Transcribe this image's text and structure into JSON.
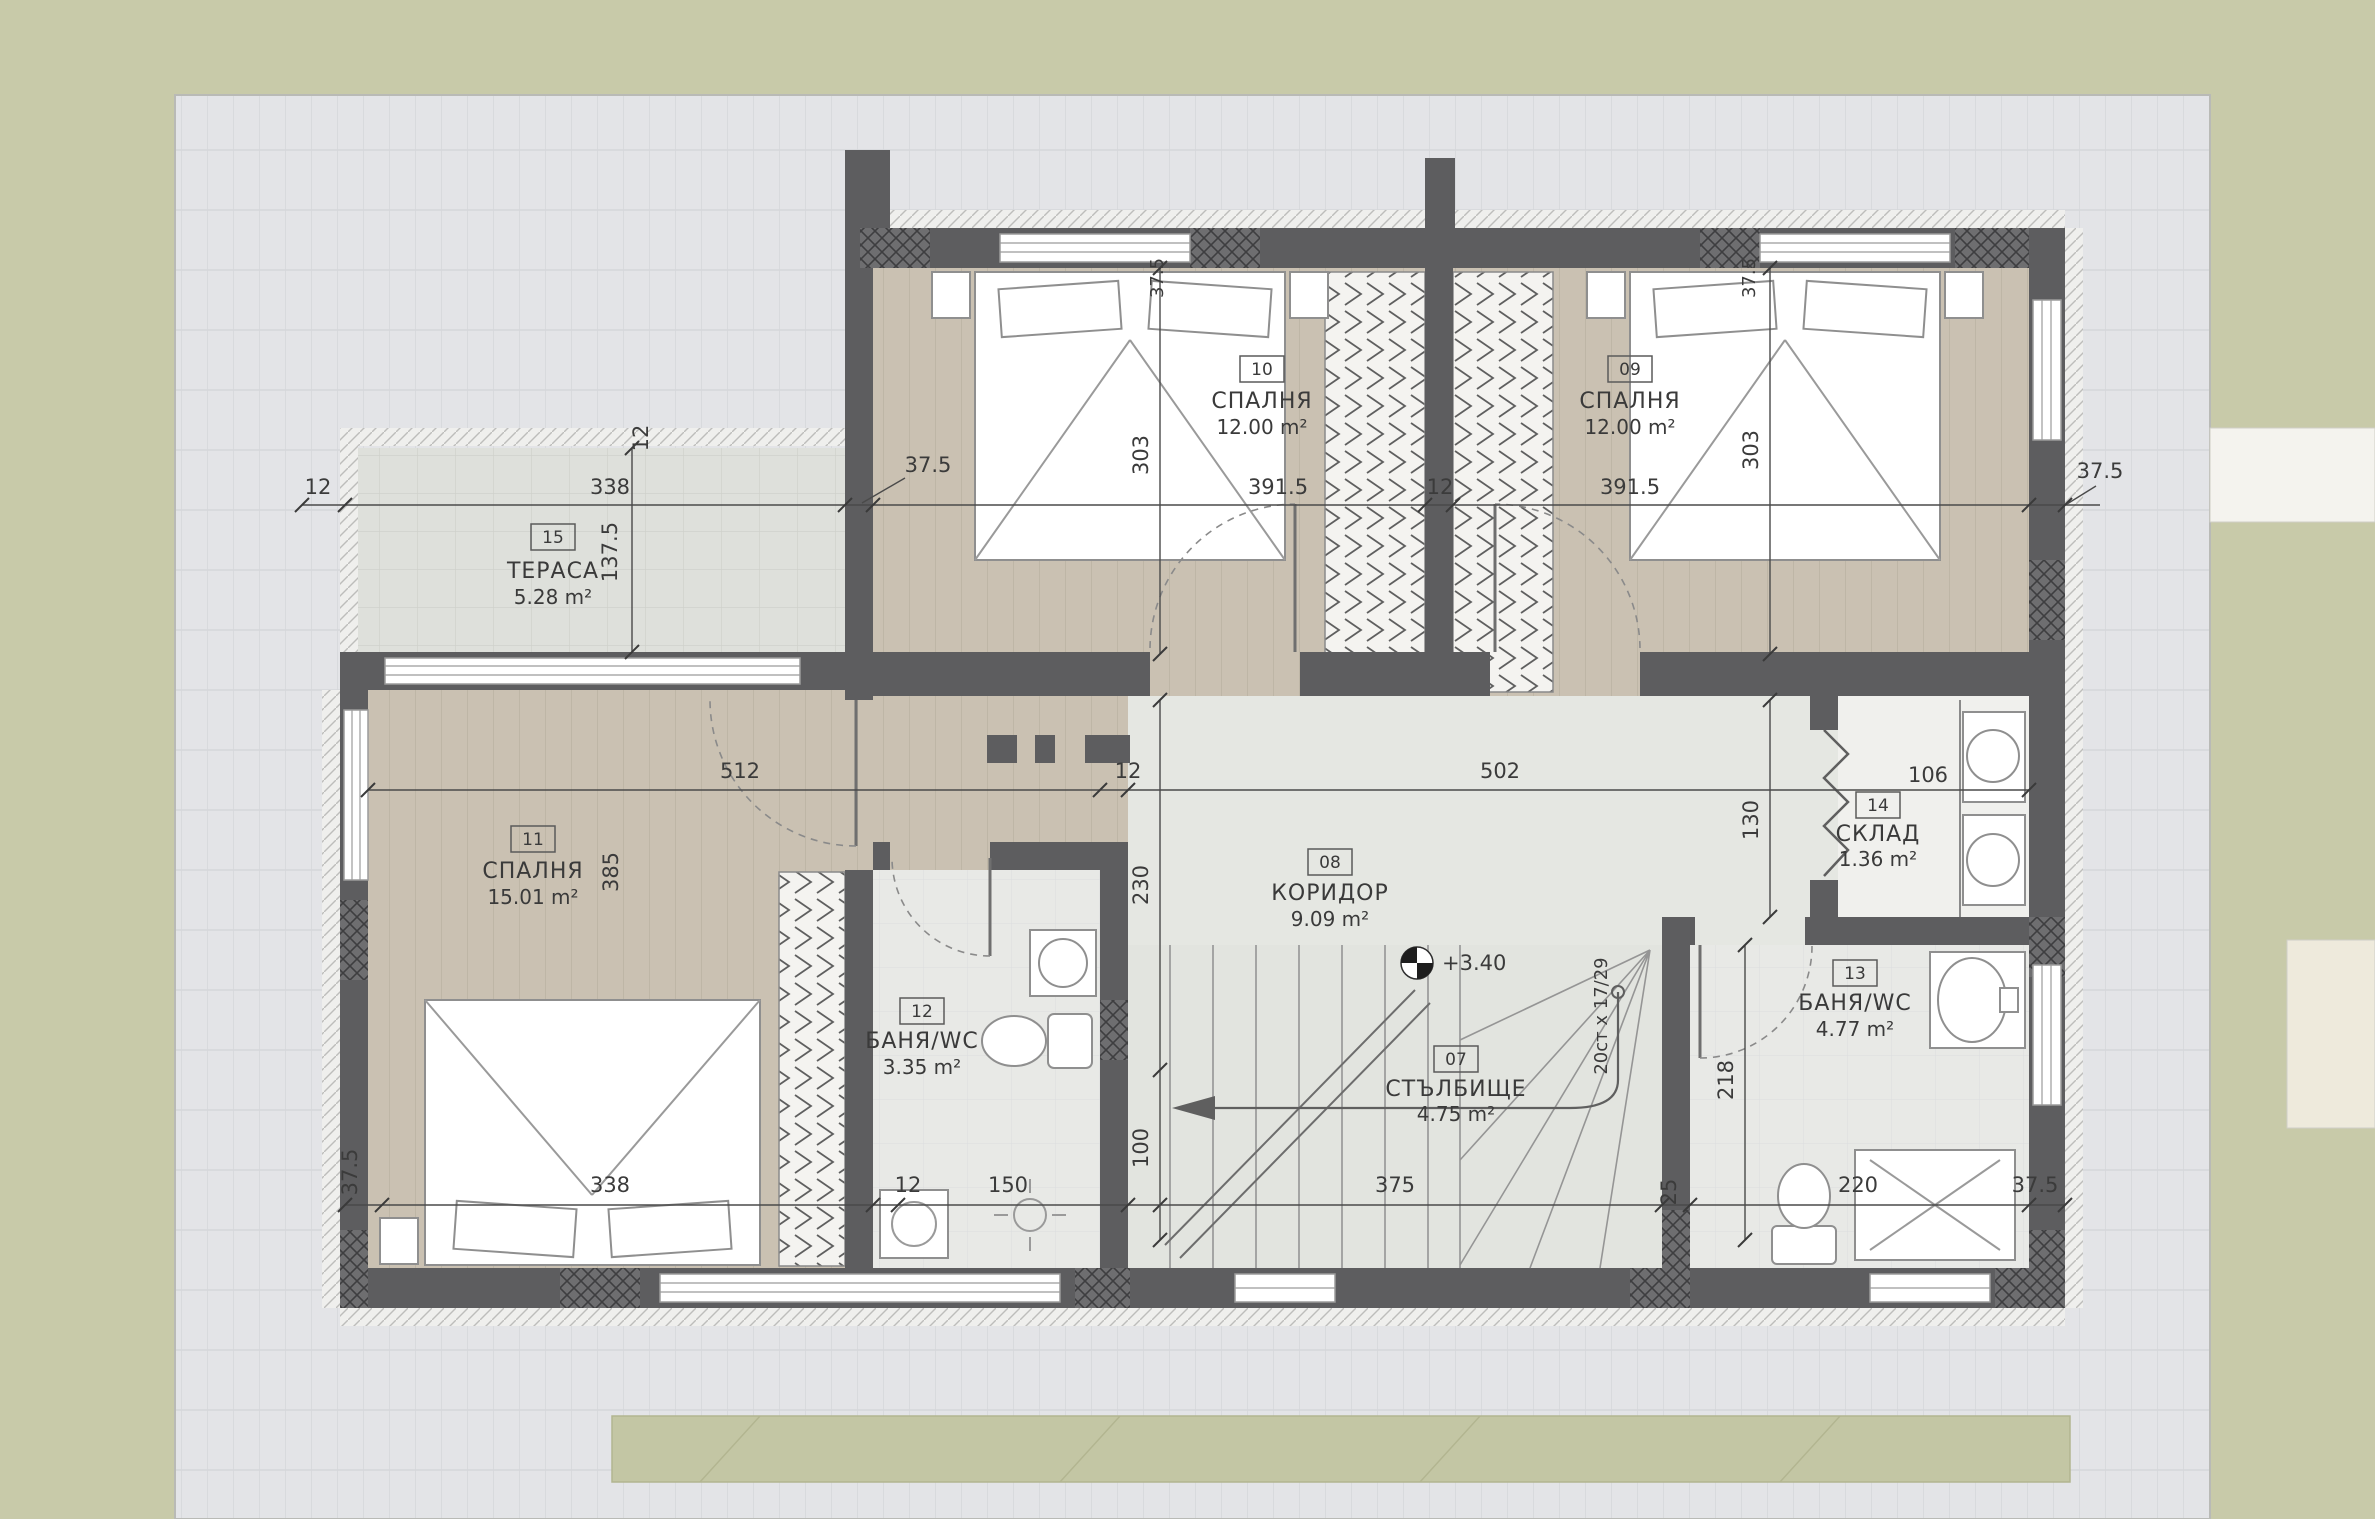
{
  "rooms": {
    "r07": {
      "tag": "07",
      "name": "СТЪЛБИЩЕ",
      "area": "4.75 m²"
    },
    "r08": {
      "tag": "08",
      "name": "КОРИДОР",
      "area": "9.09 m²"
    },
    "r09": {
      "tag": "09",
      "name": "СПАЛНЯ",
      "area": "12.00 m²"
    },
    "r10": {
      "tag": "10",
      "name": "СПАЛНЯ",
      "area": "12.00 m²"
    },
    "r11": {
      "tag": "11",
      "name": "СПАЛНЯ",
      "area": "15.01 m²"
    },
    "r12": {
      "tag": "12",
      "name": "БАНЯ/WC",
      "area": "3.35 m²"
    },
    "r13": {
      "tag": "13",
      "name": "БАНЯ/WC",
      "area": "4.77 m²"
    },
    "r14": {
      "tag": "14",
      "name": "СКЛАД",
      "area": "1.36 m²"
    },
    "r15": {
      "tag": "15",
      "name": "ТЕРАСА",
      "area": "5.28 m²"
    }
  },
  "dims": {
    "d12": "12",
    "d25": "25",
    "d37_5": "37.5",
    "d100": "100",
    "d106": "106",
    "d130": "130",
    "d137_5": "137.5",
    "d150": "150",
    "d218": "218",
    "d220": "220",
    "d230": "230",
    "d303": "303",
    "d338": "338",
    "d375": "375",
    "d385": "385",
    "d391_5": "391.5",
    "d502": "502",
    "d512": "512"
  },
  "annotations": {
    "elevation": "+3.40",
    "stair_note": "20ст x 17/29"
  },
  "colors": {
    "background": "#c8caa9",
    "pavement": "#e3e4e7",
    "wall": "#5d5d5f",
    "wood_floor": "#cac1b2",
    "corridor_floor": "#e5e7e2",
    "text": "#3b3b3b"
  }
}
